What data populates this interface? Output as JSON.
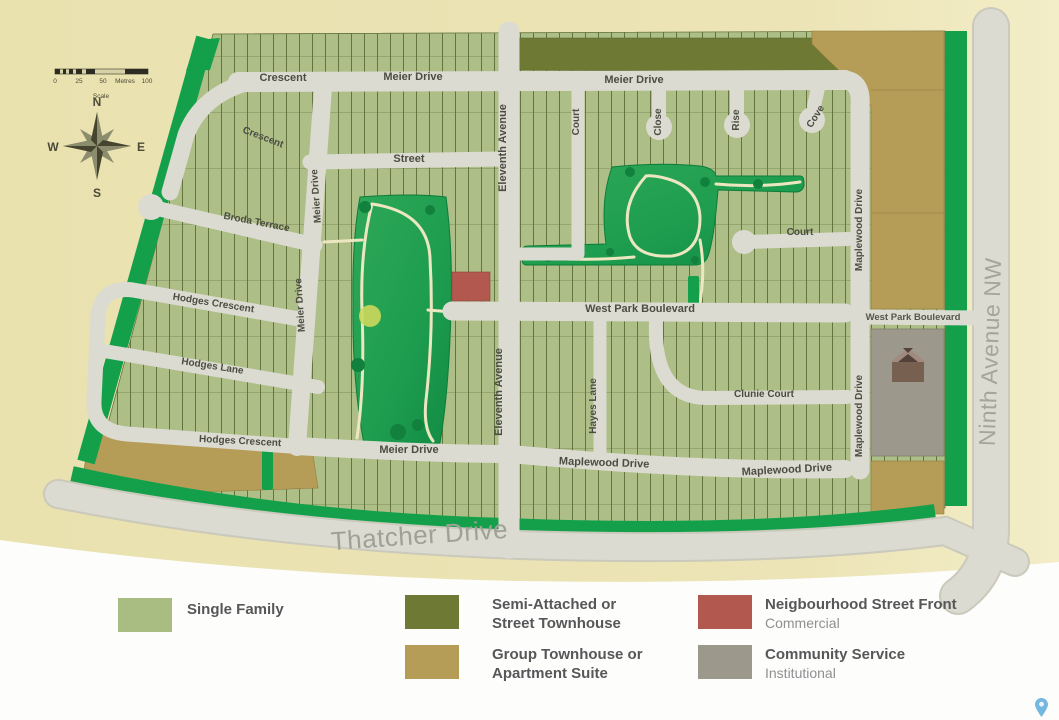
{
  "map": {
    "scale_bar": {
      "tick0": "0",
      "tick25": "25",
      "tick50": "50",
      "unit": "Metres",
      "tick100": "100",
      "caption": "Scale"
    },
    "compass": {
      "n": "N",
      "e": "E",
      "s": "S",
      "w": "W"
    },
    "streets": {
      "crescent": "Crescent",
      "meier_drive": "Meier Drive",
      "street": "Street",
      "eleventh_avenue": "Eleventh Avenue",
      "court": "Court",
      "close": "Close",
      "rise": "Rise",
      "cove": "Cove",
      "broda_terrace": "Broda Terrace",
      "hodges_crescent": "Hodges Crescent",
      "hodges_lane": "Hodges Lane",
      "west_park_boulevard": "West Park Boulevard",
      "clunie_court": "Clunie Court",
      "hayes_lane": "Hayes Lane",
      "maplewood_drive": "Maplewood Drive",
      "thatcher_drive": "Thatcher Drive",
      "ninth_avenue_nw": "Ninth Avenue NW"
    }
  },
  "legend": {
    "single_family": {
      "label": "Single Family",
      "color": "#a9bc82"
    },
    "semi_attached": {
      "label": "Semi-Attached or",
      "label2": "Street Townhouse",
      "color": "#6e7a34"
    },
    "group_townhouse": {
      "label": "Group Townhouse or",
      "label2": "Apartment Suite",
      "color": "#b59d58"
    },
    "commercial": {
      "label": "Neigbourhood Street Front",
      "sublabel": "Commercial",
      "color": "#b2584e"
    },
    "community": {
      "label": "Community Service",
      "sublabel": "Institutional",
      "color": "#9c998c"
    }
  },
  "icons": {
    "church": "church-building-icon",
    "pin": "location-pin-icon",
    "compass": "compass-rose-icon"
  }
}
